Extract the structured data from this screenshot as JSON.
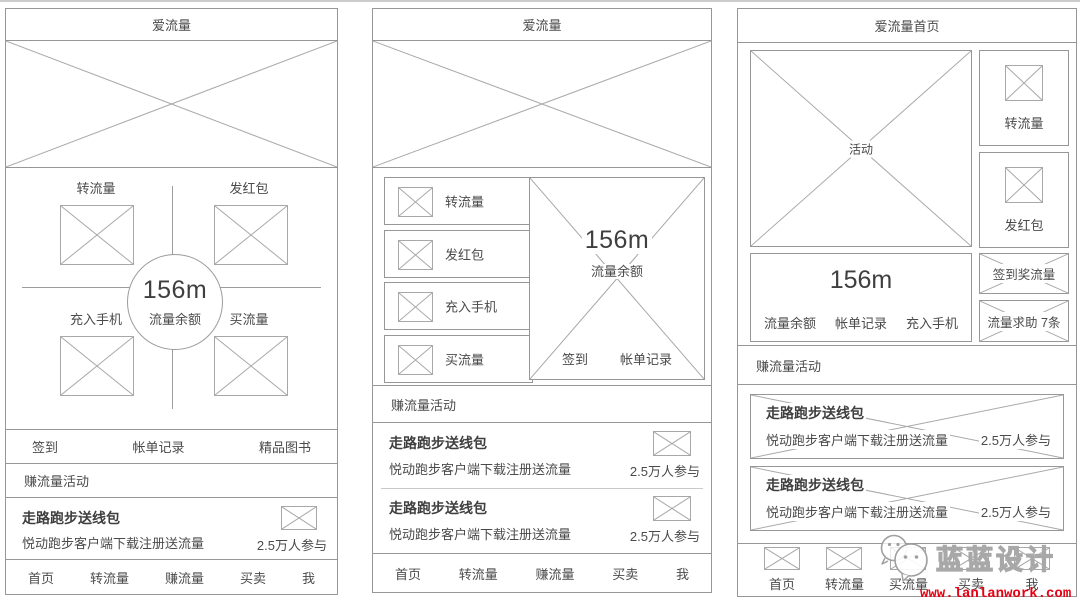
{
  "page": {
    "background": "#ffffff",
    "top_rule_color": "#cccccc",
    "border_color": "#979797",
    "text_color": "#4a4a4a",
    "url_color": "#e60012"
  },
  "icons": {
    "placeholder": "x-crossed-box-icon",
    "watermark_logo": "wechat-bubbles-icon"
  },
  "screens": [
    {
      "title": "爱流量",
      "quadrant": {
        "top_left": "转流量",
        "top_right": "发红包",
        "bottom_left": "充入手机",
        "bottom_right": "买流量",
        "balance_value": "156m",
        "balance_label": "流量余额"
      },
      "menu_row": [
        "签到",
        "帐单记录",
        "精品图书"
      ],
      "section_header": "赚流量活动",
      "cards": [
        {
          "title": "走路跑步送线包",
          "subtitle": "悦动跑步客户端下载注册送流量",
          "participants": "2.5万人参与"
        }
      ],
      "nav": [
        "首页",
        "转流量",
        "赚流量",
        "买卖",
        "我"
      ]
    },
    {
      "title": "爱流量",
      "action_buttons": [
        "转流量",
        "发红包",
        "充入手机",
        "买流量"
      ],
      "balance": {
        "value": "156m",
        "label": "流量余额",
        "links": [
          "签到",
          "帐单记录"
        ]
      },
      "section_header": "赚流量活动",
      "cards": [
        {
          "title": "走路跑步送线包",
          "subtitle": "悦动跑步客户端下载注册送流量",
          "participants": "2.5万人参与"
        },
        {
          "title": "走路跑步送线包",
          "subtitle": "悦动跑步客户端下载注册送流量",
          "participants": "2.5万人参与"
        }
      ],
      "nav": [
        "首页",
        "转流量",
        "赚流量",
        "买卖",
        "我"
      ]
    },
    {
      "title": "爱流量首页",
      "activity_label": "活动",
      "side_buttons": [
        "转流量",
        "发红包"
      ],
      "balance": {
        "value": "156m",
        "links": [
          "流量余额",
          "帐单记录",
          "充入手机"
        ]
      },
      "side_banners": [
        "签到奖流量",
        "流量求助 7条"
      ],
      "section_header": "赚流量活动",
      "cards": [
        {
          "title": "走路跑步送线包",
          "subtitle": "悦动跑步客户端下载注册送流量",
          "participants": "2.5万人参与"
        },
        {
          "title": "走路跑步送线包",
          "subtitle": "悦动跑步客户端下载注册送流量",
          "participants": "2.5万人参与"
        }
      ],
      "nav": [
        "首页",
        "转流量",
        "买流量",
        "买卖",
        "我"
      ]
    }
  ],
  "watermark": {
    "brand": "蓝蓝设计",
    "url": "www.lanlanwork.com"
  }
}
